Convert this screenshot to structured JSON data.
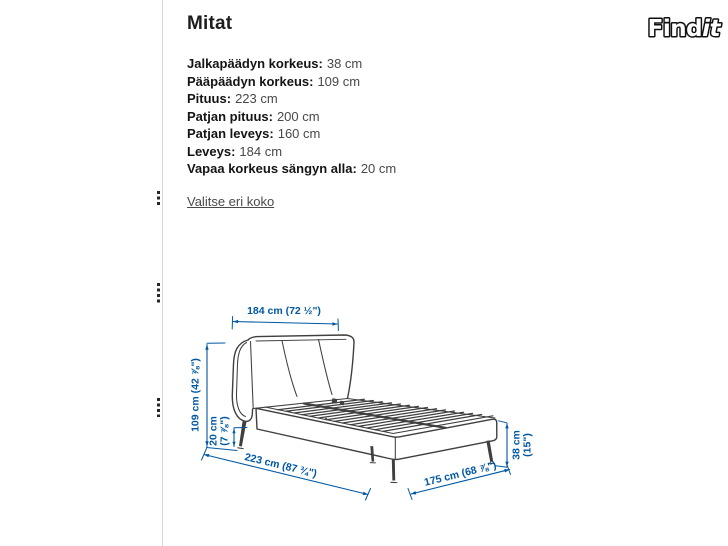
{
  "logo": {
    "text_main": "Find",
    "text_italic": "it"
  },
  "panel": {
    "title": "Mitat",
    "specs": [
      {
        "label": "Jalkapäädyn korkeus:",
        "value": "38 cm"
      },
      {
        "label": "Pääpäädyn korkeus:",
        "value": "109 cm"
      },
      {
        "label": "Pituus:",
        "value": "223 cm"
      },
      {
        "label": "Patjan pituus:",
        "value": "200 cm"
      },
      {
        "label": "Patjan leveys:",
        "value": "160 cm"
      },
      {
        "label": "Leveys:",
        "value": "184 cm"
      },
      {
        "label": "Vapaa korkeus sängyn alla:",
        "value": "20 cm"
      }
    ],
    "link": "Valitse eri koko"
  },
  "diagram": {
    "dim_top": "184 cm (72 ½\")",
    "dim_left": "109 cm (42 ⅞\")",
    "dim_clearance_l1": "20 cm",
    "dim_clearance_l2": "(7 ⅞\")",
    "dim_length": "223 cm (87 ¾\")",
    "dim_width_bottom": "175 cm (68 ⅞\")",
    "dim_foot_l1": "38 cm",
    "dim_foot_l2": "(15\")",
    "colors": {
      "dimension_blue": "#0058a3",
      "bed_line_gray": "#3f3f3f"
    }
  }
}
